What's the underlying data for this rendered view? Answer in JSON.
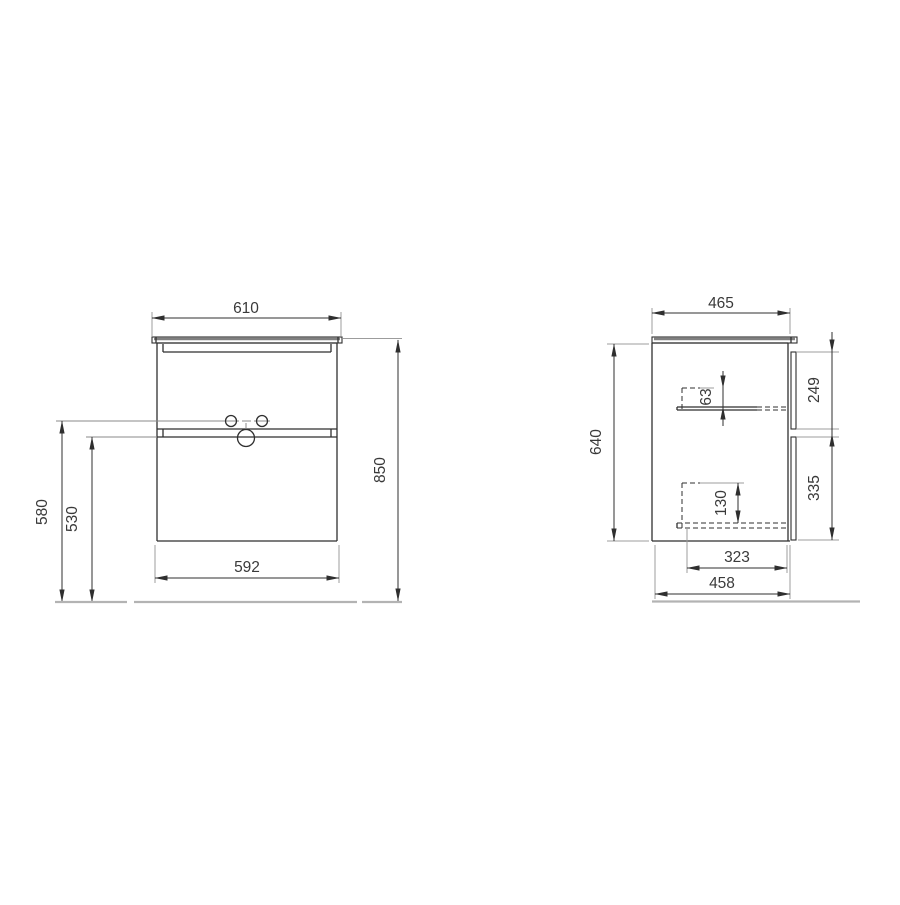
{
  "drawing": {
    "title": "two-drawer vanity cabinet dimensional drawing",
    "front_view": {
      "dim_width_top": "610",
      "dim_height_overall": "850",
      "dim_height_handle_to_floor": "580",
      "dim_height_drawer2_to_floor": "530",
      "dim_width_bottom": "592"
    },
    "side_view": {
      "dim_depth_top": "465",
      "dim_height_body": "640",
      "dim_drawer1_inner_depth": "63",
      "dim_drawer1_front_height": "249",
      "dim_drawer2_inner_depth": "130",
      "dim_drawer2_front_height": "335",
      "dim_depth_inner": "323",
      "dim_depth_bottom": "458"
    },
    "colors": {
      "object_line": "#2f2f2f",
      "extension_line": "#9c9c9c",
      "floor_line": "#b3b3b3",
      "text": "#3a3a3a",
      "background": "#ffffff"
    }
  }
}
